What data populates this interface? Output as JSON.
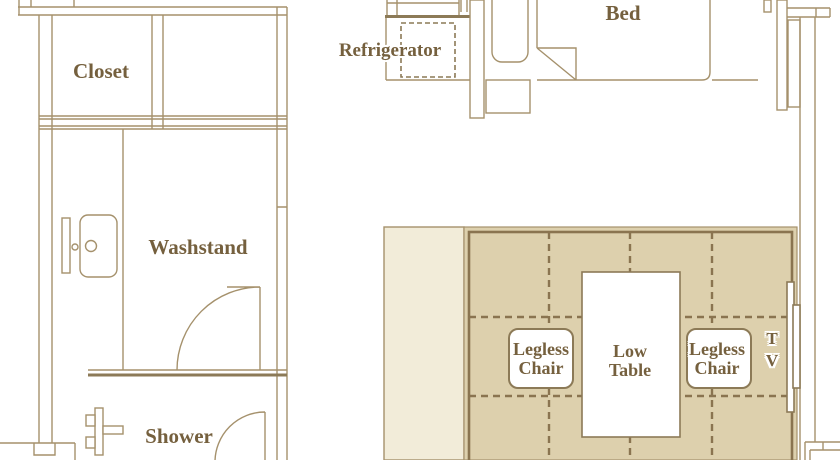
{
  "floorplan": {
    "labels": {
      "closet": "Closet",
      "refrigerator": "Refrigerator",
      "bed": "Bed",
      "washstand": "Washstand",
      "shower": "Shower",
      "legless_chair": {
        "line1": "Legless",
        "line2": "Chair"
      },
      "low_table": {
        "line1": "Low",
        "line2": "Table"
      },
      "tv": {
        "line1": "T",
        "line2": "V"
      }
    },
    "colors": {
      "background": "#ffffff",
      "wall": "#a5916c",
      "wall_dark": "#8c7a57",
      "text": "#75603e",
      "tatami_fill": "#ddd0ad",
      "strip_fill": "#f2ecd9",
      "dash": "#8a7450"
    }
  }
}
